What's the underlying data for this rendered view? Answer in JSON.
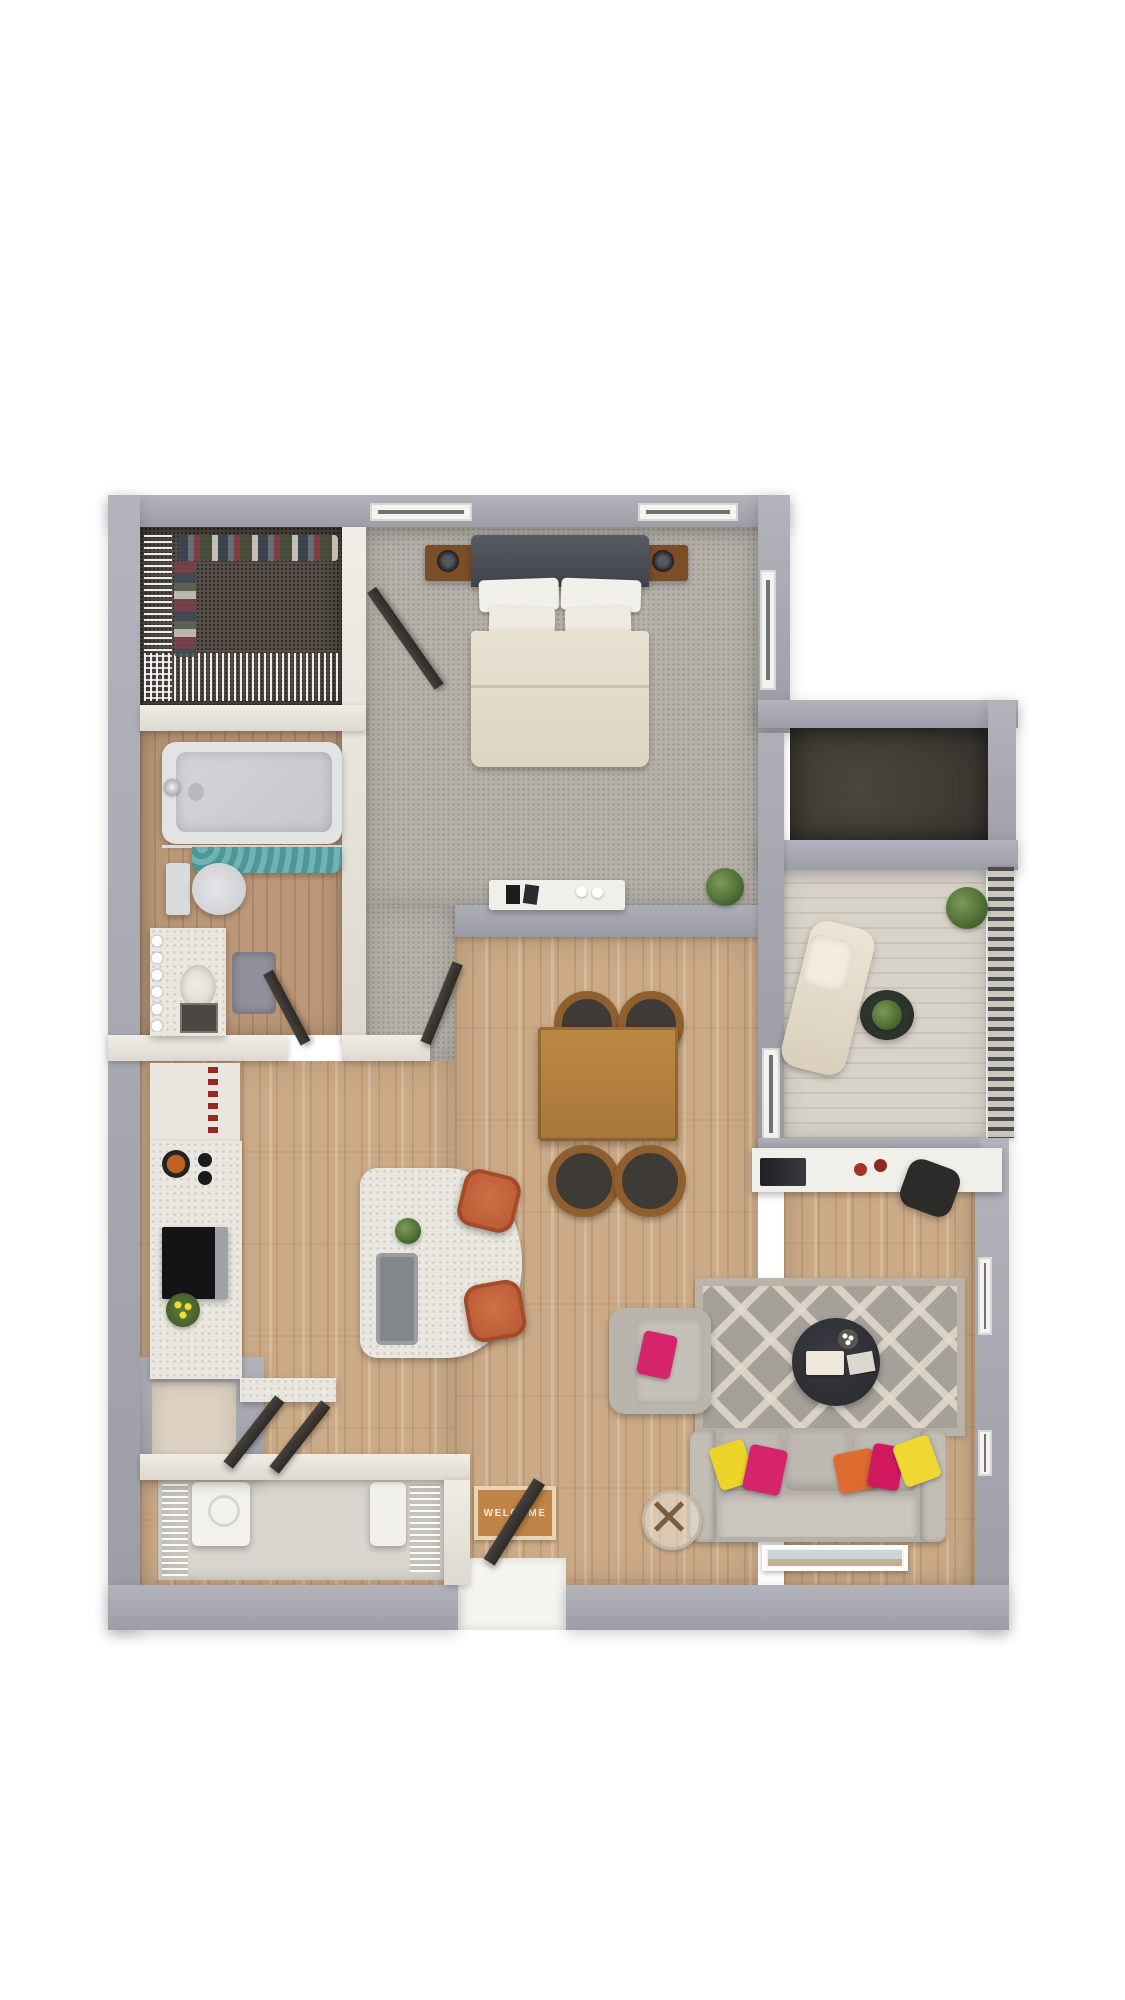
{
  "floorplan": {
    "type": "3d-top-down-apartment-floor-plan",
    "welcome_mat": "WELCOME",
    "rooms": [
      {
        "id": "bedroom",
        "floor": "gray-carpet",
        "furniture": [
          "queen-bed",
          "headboard",
          "pillows-x4",
          "duvet",
          "nightstand-left",
          "nightstand-right",
          "lamp-left",
          "lamp-right",
          "dresser",
          "dresser-decor",
          "potted-plant",
          "window-left",
          "window-right",
          "side-window",
          "closet-door",
          "entry-door"
        ]
      },
      {
        "id": "walk-in-closet",
        "floor": "dark-carpet",
        "furniture": [
          "wire-shelving-left",
          "wire-shelving-bottom",
          "hanging-clothes"
        ]
      },
      {
        "id": "bathroom",
        "floor": "wood",
        "furniture": [
          "bathtub",
          "tub-faucet",
          "shower-curtain-teal",
          "toilet",
          "vanity-counter",
          "vanity-sink",
          "hollywood-bulbs",
          "vanity-drawers",
          "bath-mat",
          "door"
        ]
      },
      {
        "id": "kitchen",
        "floor": "wood",
        "furniture": [
          "pantry-shelves",
          "red-spice-jars",
          "cooktop-pan",
          "burners",
          "range-oven",
          "yellow-flowers",
          "counter-marble",
          "counter-return",
          "island-marble",
          "island-sink",
          "island-plant",
          "bar-stool-upper",
          "bar-stool-lower"
        ]
      },
      {
        "id": "dining-area",
        "floor": "wood",
        "furniture": [
          "dining-table",
          "dining-chair-tl",
          "dining-chair-tr",
          "dining-chair-bl",
          "dining-chair-br"
        ]
      },
      {
        "id": "living-room",
        "floor": "wood",
        "furniture": [
          "area-rug-lattice",
          "sofa",
          "sofa-pillows-x5",
          "loveseat",
          "loveseat-pillow",
          "coffee-table-round",
          "coffee-table-decor",
          "glass-side-table",
          "leaning-artwork",
          "built-in-desk",
          "laptop",
          "red-mugs",
          "desk-chair",
          "right-windows"
        ]
      },
      {
        "id": "balcony",
        "floor": "concrete-deck",
        "furniture": [
          "lounge-chair",
          "round-plant-table",
          "corner-plant",
          "slatted-railing",
          "sliding-glass-door"
        ]
      },
      {
        "id": "storage-room",
        "floor": "dark-concrete",
        "furniture": []
      },
      {
        "id": "laundry-room",
        "floor": "concrete",
        "furniture": [
          "washer",
          "dryer",
          "wire-shelf-left",
          "wire-shelf-right"
        ]
      },
      {
        "id": "entry",
        "floor": "wood",
        "furniture": [
          "front-door",
          "welcome-mat",
          "leaning-folded-chairs",
          "exterior-nook"
        ]
      }
    ],
    "colors": {
      "background": "#ffffff",
      "outer_wall": "#a1a1ab",
      "inner_wall": "#e8e6df",
      "bedroom_carpet": "#b6b1aa",
      "closet_carpet": "#57504a",
      "wood_floor": "#cba987",
      "bath_wood": "#bb9878",
      "balcony_concrete": "#d8d3c9",
      "marble": "#eae7e0",
      "sofa_gray": "#bcb7af",
      "rug_gray": "#a5a098",
      "pillow_pink": "#d6246c",
      "pillow_orange": "#dd6a2f",
      "pillow_yellow": "#edd428",
      "shower_curtain_teal": "#58a3a4",
      "stool_rust": "#bf5f3a",
      "dining_wood": "#b5823f",
      "mat_orange": "#c08447"
    }
  }
}
